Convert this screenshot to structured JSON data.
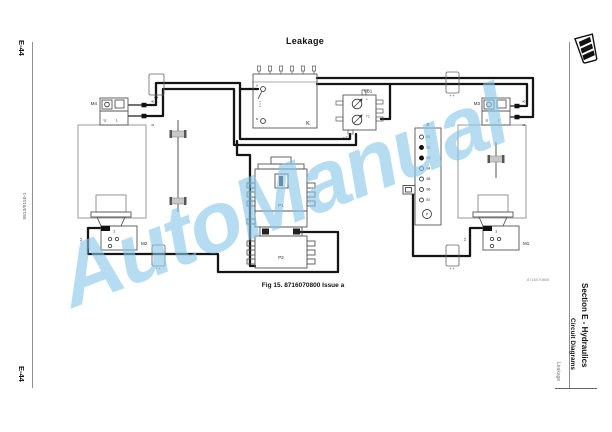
{
  "page": {
    "title": "Leakage",
    "caption": "Fig 15. 8716070800 Issue a",
    "ref_number_small": "8716070800",
    "side_left": {
      "page_ref_top": "E-44",
      "page_ref_bottom": "E-44",
      "doc_number": "9813/0150-1"
    },
    "side_right": {
      "section": "Section E - Hydraulics",
      "subsection": "Circuit Diagrams",
      "topic": "Leakage",
      "logo_text": "JCB"
    },
    "watermark": "AutoManual",
    "colors": {
      "watermark_blue": "#87c6e9",
      "wire_black": "#151515",
      "outline_gray": "#999999"
    }
  },
  "diagram": {
    "k_unit": {
      "label": "K",
      "terminal_a": "A",
      "terminal_b": "B"
    },
    "vb1": {
      "label": "VB1",
      "corner_mark": "+ T",
      "mark_top": "+",
      "mark_mid": "T2"
    },
    "m4": {
      "label": "M4",
      "pin_u": "U",
      "pin_l": "L",
      "wire_top": "40",
      "wire_bottom": "41"
    },
    "m3": {
      "label": "M3",
      "pin_u": "U",
      "pin_l": "L",
      "wire_top": "40",
      "wire_bottom": "41"
    },
    "m2": {
      "label": "M2",
      "pin1": "1",
      "wire_number": "16"
    },
    "m1": {
      "label": "M1",
      "pin1": "1",
      "wire_number": "16"
    },
    "b_unit": {
      "label": "B",
      "terminals": [
        "B1",
        "B2",
        "B3",
        "B4",
        "B5",
        "B6",
        "B7"
      ],
      "gauge": "P"
    },
    "p1": {
      "label": "P1"
    },
    "p2": {
      "label": "P2"
    },
    "splice_mark": "+ +"
  }
}
